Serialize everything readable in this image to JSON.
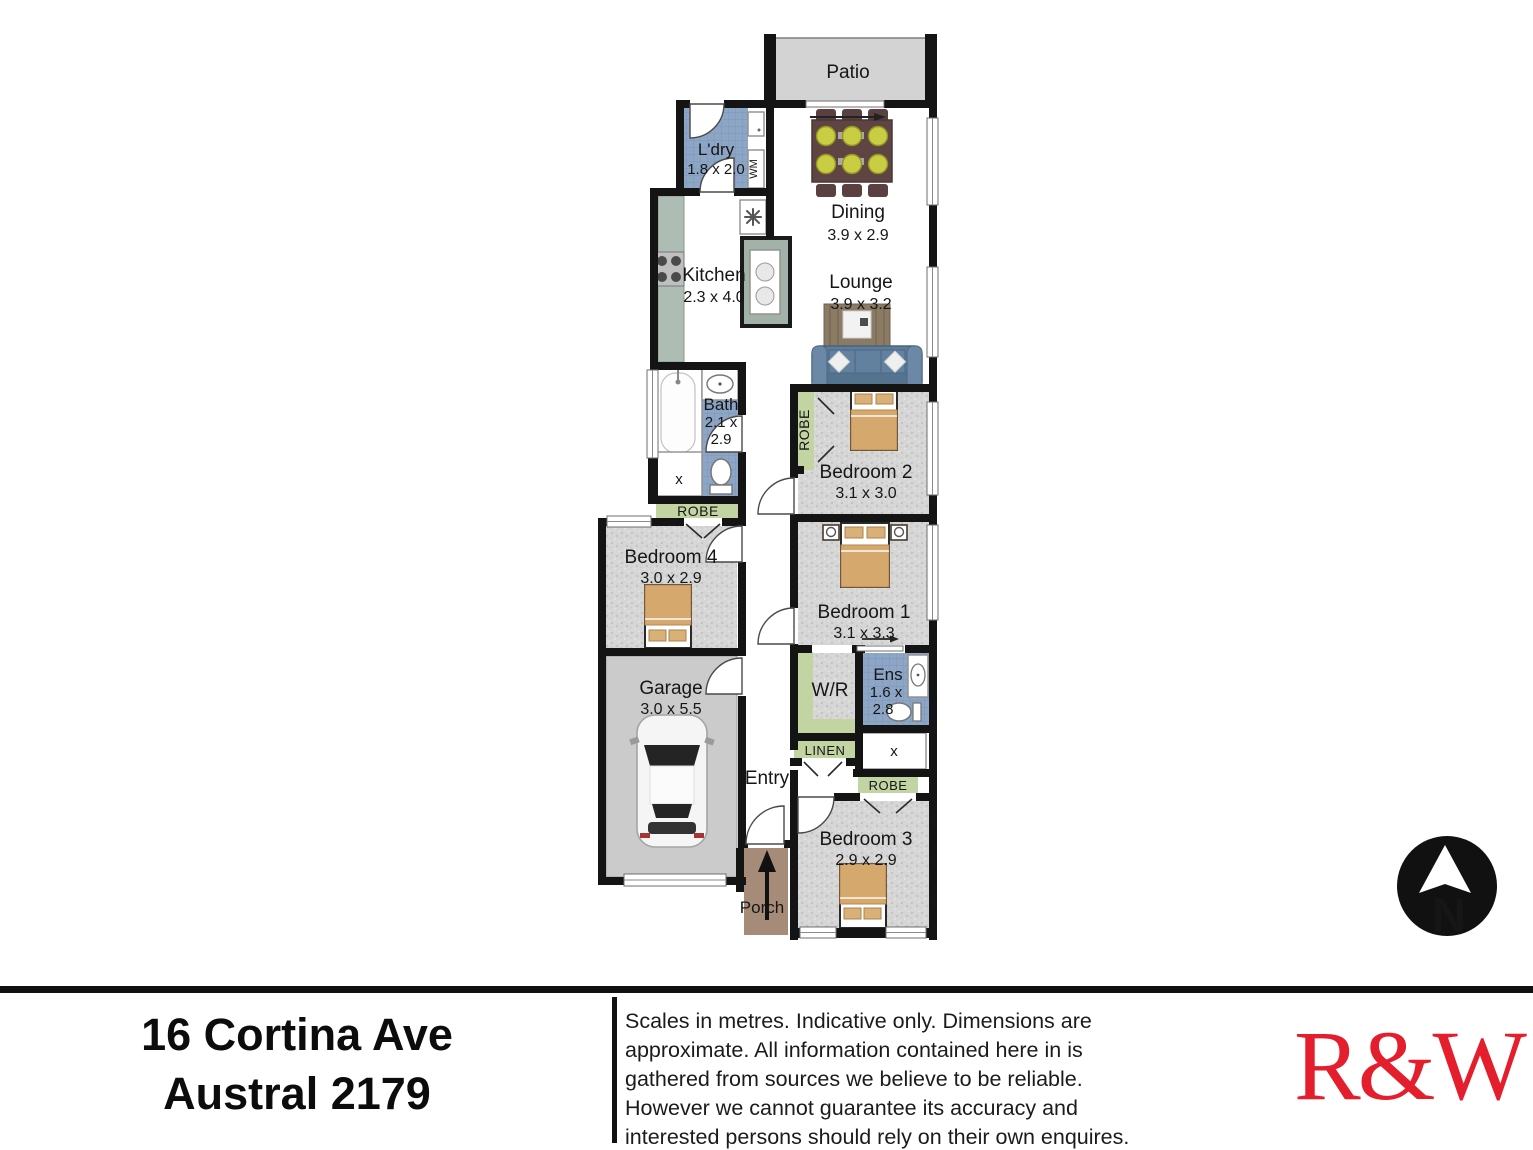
{
  "plan": {
    "rooms": {
      "patio": {
        "label": "Patio"
      },
      "ldry": {
        "label": "L'dry",
        "dims": "1.8 x 2.0"
      },
      "dining": {
        "label": "Dining",
        "dims": "3.9 x 2.9"
      },
      "kitchen": {
        "label": "Kitchen",
        "dims": "2.3 x 4.0"
      },
      "lounge": {
        "label": "Lounge",
        "dims": "3.9 x 3.2"
      },
      "bath": {
        "label": "Bath",
        "dims_line1": "2.1 x",
        "dims_line2": "2.9"
      },
      "bedroom2": {
        "label": "Bedroom 2",
        "dims": "3.1 x 3.0"
      },
      "bedroom4": {
        "label": "Bedroom 4",
        "dims": "3.0 x 2.9"
      },
      "bedroom1": {
        "label": "Bedroom 1",
        "dims": "3.1 x 3.3"
      },
      "garage": {
        "label": "Garage",
        "dims": "3.0 x 5.5"
      },
      "wr": {
        "label": "W/R"
      },
      "ens": {
        "label": "Ens",
        "dims_line1": "1.6 x",
        "dims_line2": "2.8"
      },
      "entry": {
        "label": "Entry"
      },
      "bedroom3": {
        "label": "Bedroom 3",
        "dims": "2.9 x 2.9"
      },
      "porch": {
        "label": "Porch"
      }
    },
    "storage": {
      "robe": "ROBE",
      "linen": "LINEN"
    },
    "appliances": {
      "washing_machine": "WM",
      "shower_mark": "x"
    },
    "compass": {
      "letter": "N"
    }
  },
  "colors": {
    "wall": "#141414",
    "tile_blue": "#8da6c6",
    "carpet_grey": "#d6d6d6",
    "robe_green": "#c3d4a3",
    "counter_green": "#aebdb3",
    "island_green": "#a3b2a8",
    "garage_grey": "#cbcbcb",
    "patio_grey": "#d3d3d3",
    "porch_brown": "#a78b79",
    "sofa_blue": "#5e7d9b",
    "bed_tan": "#d5a96e",
    "logo_red": "#e41e2d"
  },
  "footer": {
    "address_line1": "16 Cortina Ave",
    "address_line2": "Austral 2179",
    "disclaimer_lines": [
      "Scales in metres. Indicative only. Dimensions are",
      "approximate. All information contained here in is",
      "gathered from sources we believe to be reliable.",
      "However we cannot guarantee its accuracy and",
      "interested persons should rely on their own enquires."
    ],
    "logo_text": "R&W"
  }
}
